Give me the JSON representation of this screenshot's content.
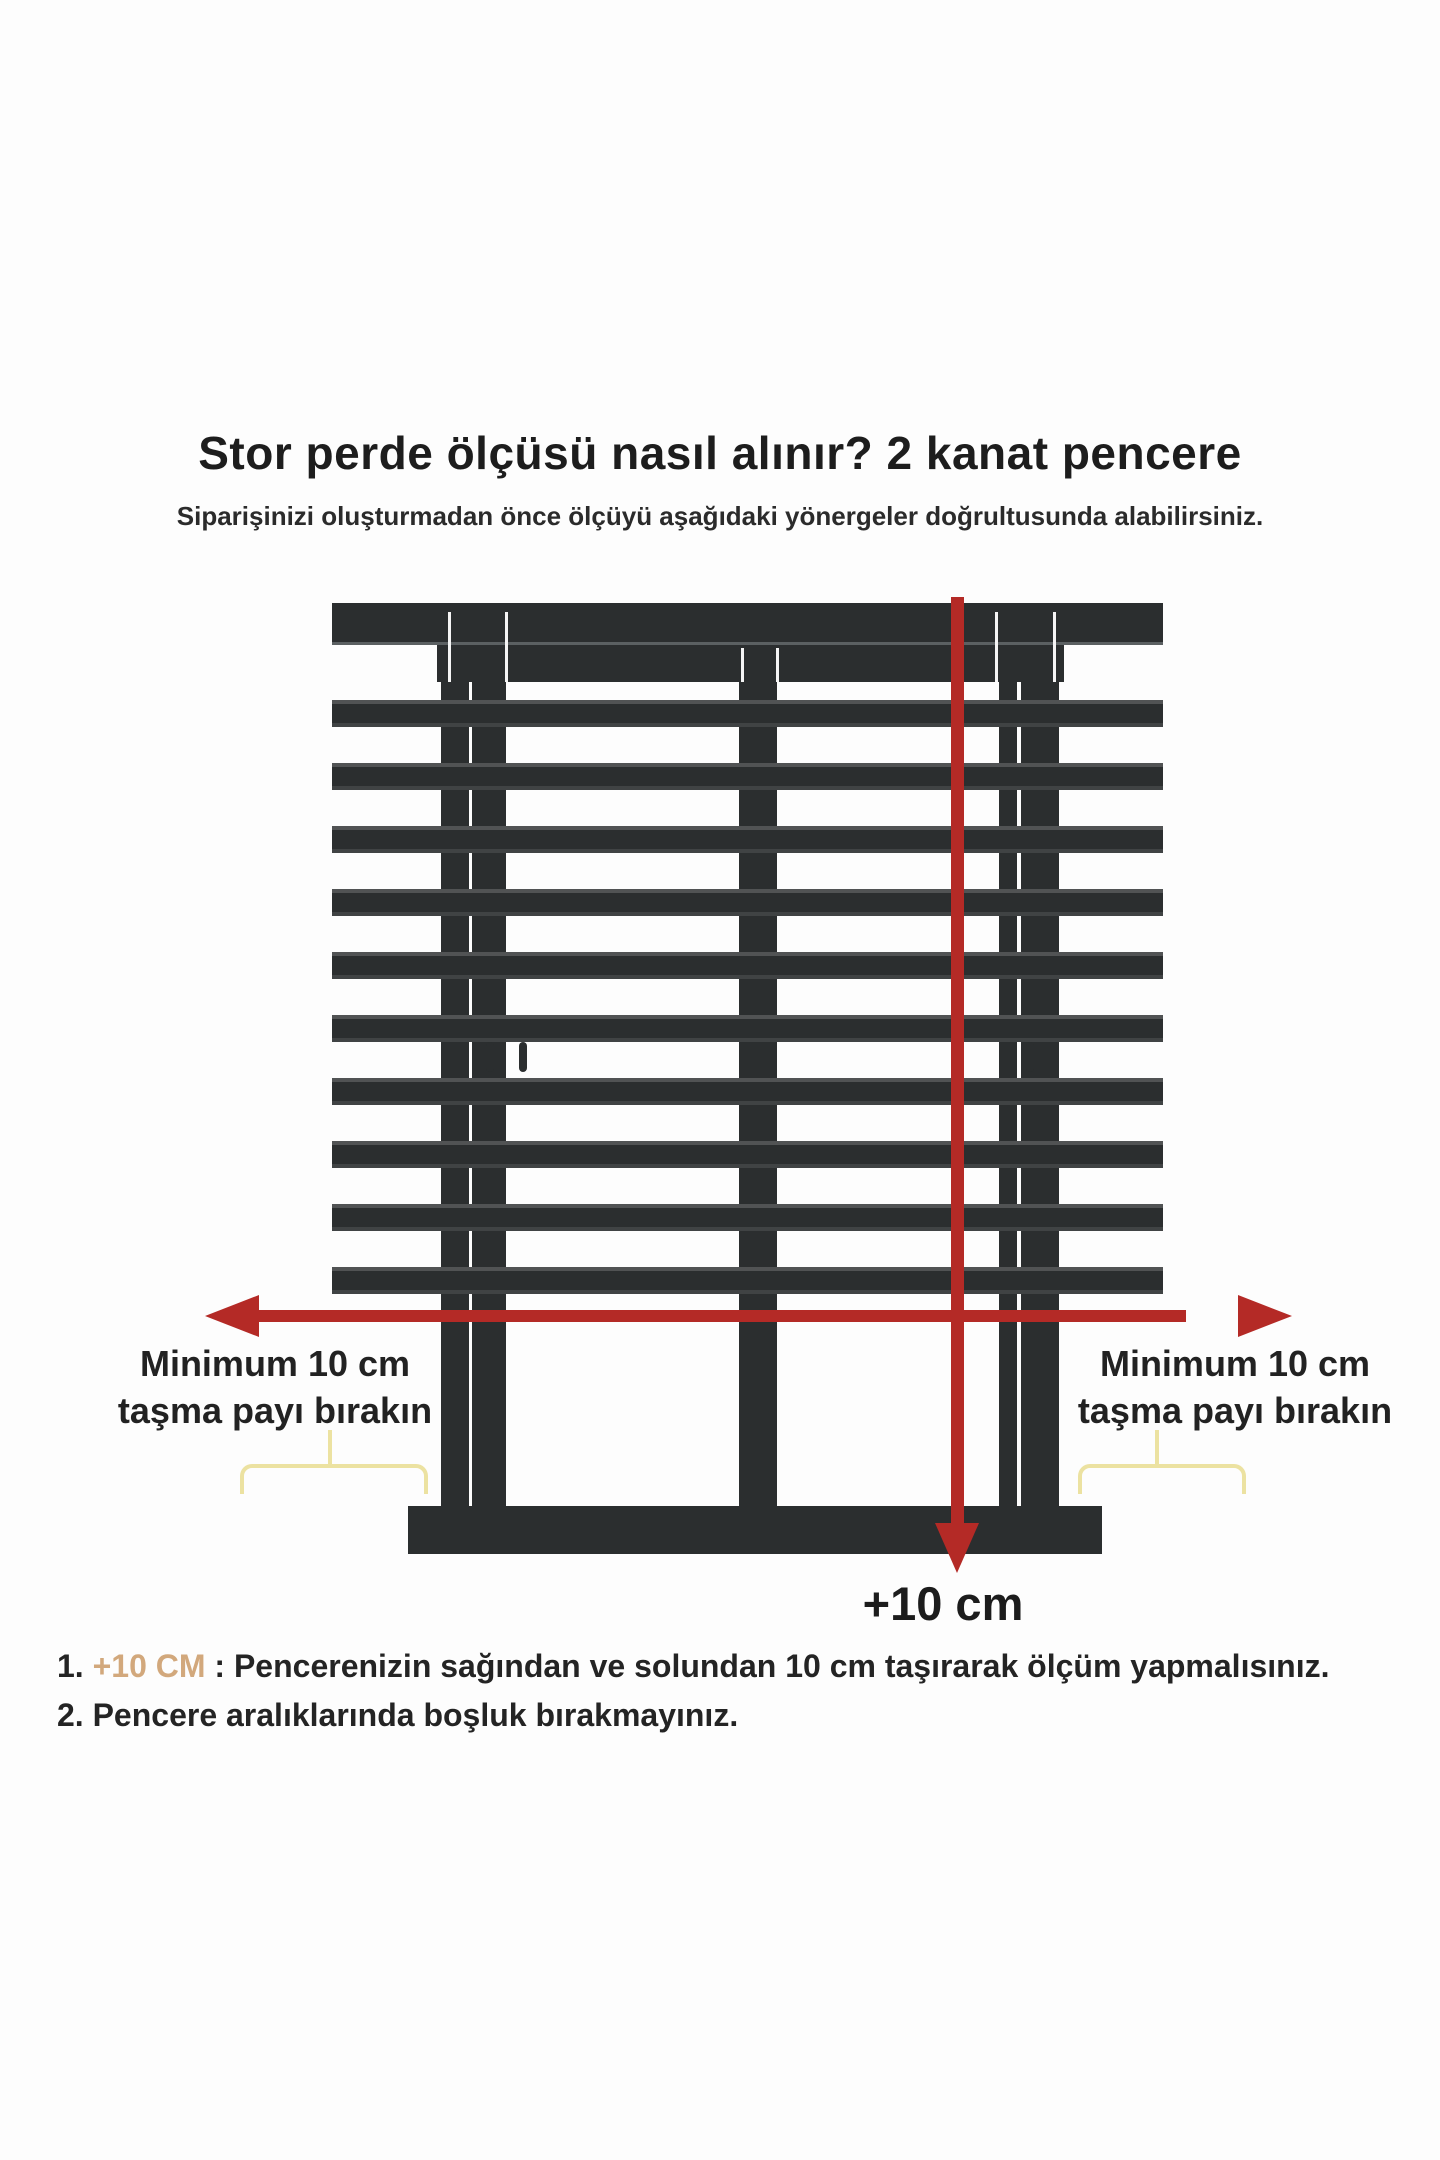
{
  "page": {
    "title": "Stor perde ölçüsü nasıl alınır? 2 kanat pencere",
    "subtitle": "Siparişinizi oluşturmadan önce ölçüyü aşağıdaki yönergeler doğrultusunda alabilirsiniz."
  },
  "diagram": {
    "left_overhang_label": {
      "line1": "Minimum 10 cm",
      "line2": "taşma payı bırakın"
    },
    "right_overhang_label": {
      "line1": "Minimum 10 cm",
      "line2": "taşma payı bırakın"
    },
    "bottom_arrow_label": "+10 cm",
    "blind": {
      "slat_count": 10,
      "window_panes": 2
    }
  },
  "notes": [
    {
      "number": "1.",
      "highlight": "+10 CM",
      "text": " : Pencerenizin sağından ve solundan 10 cm taşırarak ölçüm yapmalısınız."
    },
    {
      "number": "2.",
      "highlight": "",
      "text": " Pencere aralıklarında boşluk bırakmayınız."
    }
  ],
  "colors": {
    "dark": "#2b2e2f",
    "red": "#b42a26",
    "yellow": "#ece2a1",
    "tan": "#d2a87c"
  }
}
